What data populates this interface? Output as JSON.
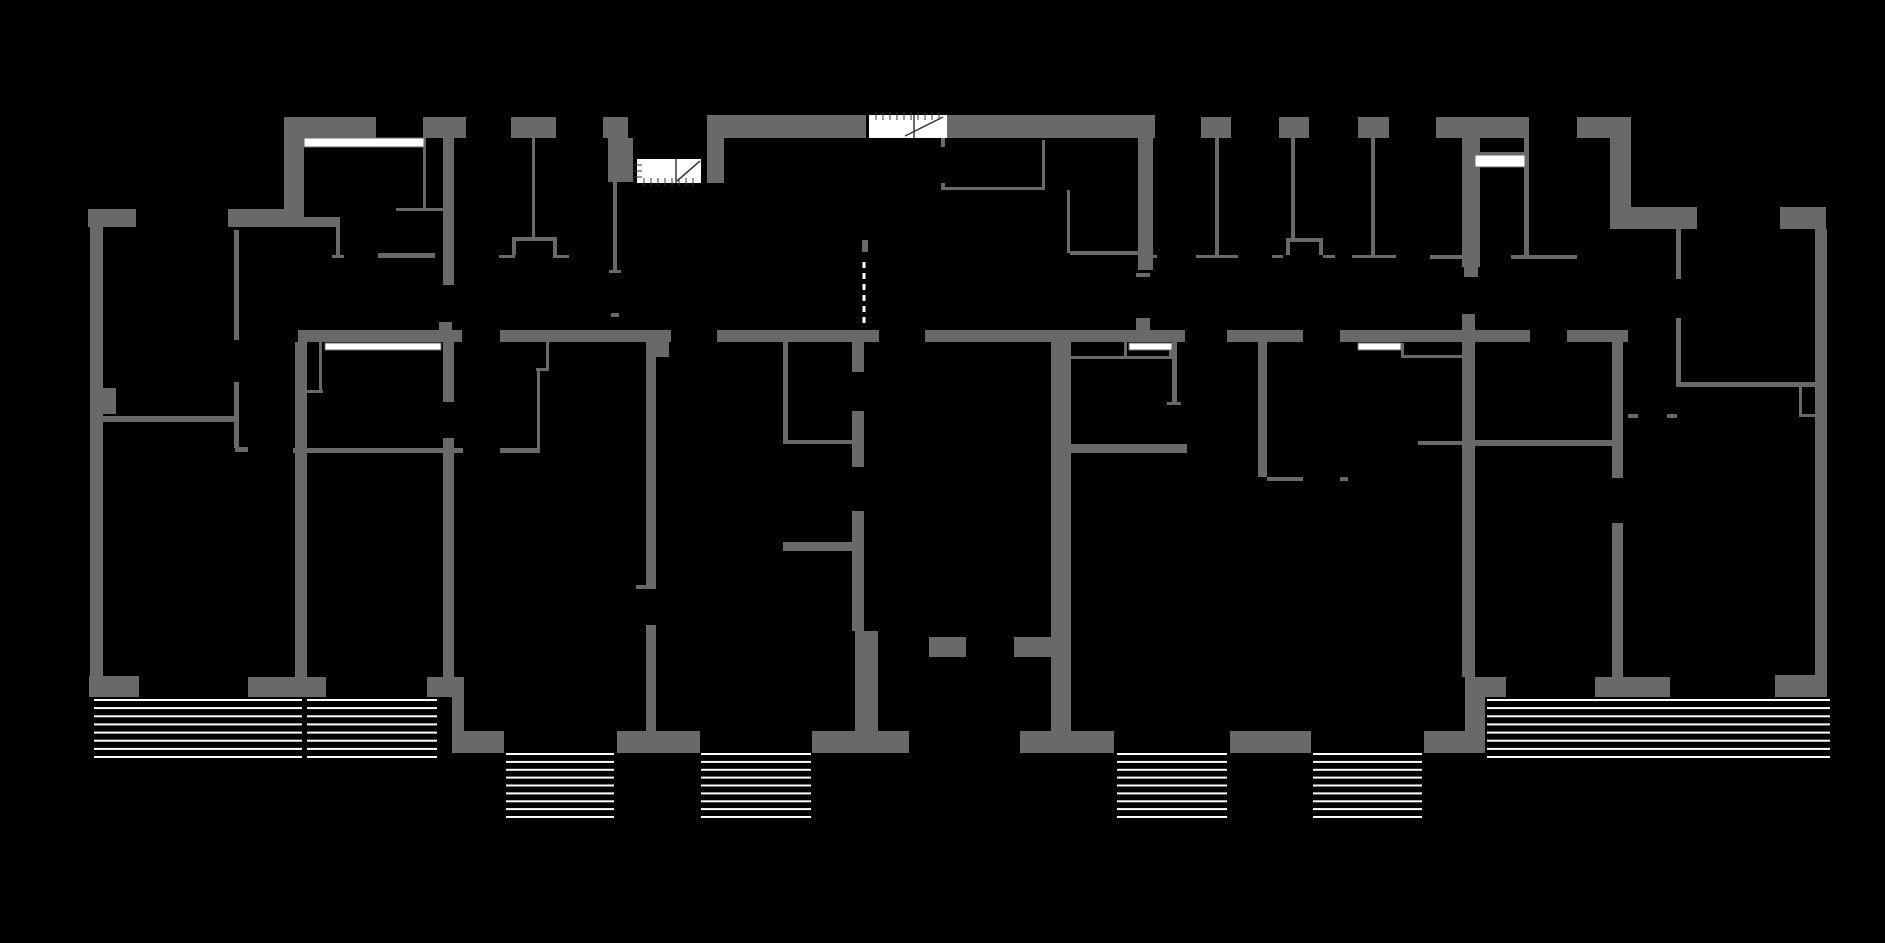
{
  "meta": {
    "canvas": {
      "width": 1885,
      "height": 943
    },
    "colors": {
      "background": "#000000",
      "wall": "#696969",
      "window": "#ffffff",
      "hatch": "#ffffff",
      "stair_fill": "#ffffff",
      "stair_line": "#3a3a3a"
    }
  },
  "walls": [
    [
      284,
      117,
      92,
      21
    ],
    [
      284,
      138,
      20,
      71
    ],
    [
      88,
      209,
      48,
      18
    ],
    [
      228,
      209,
      76,
      18
    ],
    [
      304,
      217,
      36,
      10
    ],
    [
      90,
      227,
      13,
      449
    ],
    [
      103,
      388,
      13,
      26
    ],
    [
      89,
      676,
      50,
      21
    ],
    [
      423,
      117,
      43,
      21
    ],
    [
      443,
      138,
      11,
      147
    ],
    [
      511,
      117,
      45,
      21
    ],
    [
      603,
      117,
      25,
      21
    ],
    [
      608,
      138,
      25,
      44
    ],
    [
      707,
      115,
      159,
      23
    ],
    [
      707,
      138,
      17,
      45
    ],
    [
      942,
      115,
      213,
      23
    ],
    [
      1138,
      138,
      15,
      132
    ],
    [
      1136,
      318,
      14,
      13
    ],
    [
      1201,
      117,
      30,
      21
    ],
    [
      1279,
      117,
      30,
      21
    ],
    [
      1358,
      117,
      31,
      21
    ],
    [
      1436,
      117,
      93,
      21
    ],
    [
      1462,
      138,
      18,
      129
    ],
    [
      1577,
      117,
      54,
      21
    ],
    [
      1610,
      138,
      21,
      73
    ],
    [
      1610,
      207,
      87,
      22
    ],
    [
      1780,
      207,
      46,
      22
    ],
    [
      1815,
      229,
      12,
      468
    ],
    [
      298,
      330,
      164,
      12
    ],
    [
      500,
      330,
      171,
      12
    ],
    [
      717,
      330,
      162,
      12
    ],
    [
      925,
      330,
      260,
      12
    ],
    [
      1227,
      330,
      76,
      12
    ],
    [
      1340,
      330,
      190,
      12
    ],
    [
      1567,
      330,
      61,
      12
    ],
    [
      439,
      322,
      13,
      9
    ],
    [
      295,
      342,
      12,
      335
    ],
    [
      443,
      342,
      11,
      60
    ],
    [
      443,
      438,
      11,
      239
    ],
    [
      248,
      677,
      78,
      20
    ],
    [
      427,
      677,
      37,
      20
    ],
    [
      452,
      697,
      12,
      34
    ],
    [
      452,
      731,
      52,
      22
    ],
    [
      103,
      416,
      134,
      6
    ],
    [
      646,
      341,
      10,
      246
    ],
    [
      646,
      625,
      10,
      106
    ],
    [
      656,
      341,
      13,
      16
    ],
    [
      617,
      731,
      83,
      22
    ],
    [
      783,
      542,
      76,
      9
    ],
    [
      852,
      341,
      12,
      31
    ],
    [
      852,
      411,
      12,
      56
    ],
    [
      852,
      511,
      12,
      120
    ],
    [
      855,
      631,
      23,
      100
    ],
    [
      812,
      731,
      97,
      22
    ],
    [
      929,
      637,
      37,
      20
    ],
    [
      1014,
      637,
      40,
      20
    ],
    [
      1051,
      342,
      20,
      389
    ],
    [
      1020,
      731,
      94,
      22
    ],
    [
      1067,
      444,
      120,
      9
    ],
    [
      1230,
      731,
      81,
      22
    ],
    [
      1258,
      341,
      9,
      136
    ],
    [
      1462,
      314,
      13,
      363
    ],
    [
      1424,
      731,
      61,
      22
    ],
    [
      1465,
      677,
      20,
      54
    ],
    [
      1462,
      440,
      150,
      6
    ],
    [
      1612,
      342,
      11,
      136
    ],
    [
      1612,
      523,
      11,
      154
    ],
    [
      1595,
      677,
      75,
      20
    ],
    [
      1477,
      677,
      29,
      20
    ],
    [
      1775,
      675,
      52,
      22
    ],
    [
      1678,
      382,
      137,
      5
    ]
  ],
  "partitions": [
    [
      234,
      230,
      5,
      110
    ],
    [
      234,
      382,
      5,
      66
    ],
    [
      235,
      447,
      13,
      5
    ],
    [
      293,
      448,
      170,
      5
    ],
    [
      500,
      448,
      40,
      5
    ],
    [
      396,
      208,
      47,
      3
    ],
    [
      423,
      138,
      3,
      70
    ],
    [
      378,
      253,
      57,
      5
    ],
    [
      336,
      227,
      4,
      30
    ],
    [
      332,
      255,
      12,
      3
    ],
    [
      319,
      342,
      3,
      50
    ],
    [
      306,
      390,
      17,
      3
    ],
    [
      546,
      342,
      3,
      28
    ],
    [
      536,
      368,
      13,
      3
    ],
    [
      537,
      371,
      3,
      77
    ],
    [
      532,
      138,
      3,
      99
    ],
    [
      512,
      237,
      45,
      4
    ],
    [
      512,
      241,
      4,
      14
    ],
    [
      553,
      241,
      4,
      14
    ],
    [
      499,
      255,
      16,
      3
    ],
    [
      553,
      255,
      16,
      3
    ],
    [
      613,
      182,
      4,
      91
    ],
    [
      609,
      270,
      12,
      3
    ],
    [
      611,
      313,
      8,
      4
    ],
    [
      941,
      138,
      4,
      9
    ],
    [
      941,
      183,
      4,
      7
    ],
    [
      941,
      187,
      104,
      3
    ],
    [
      1042,
      140,
      3,
      49
    ],
    [
      1067,
      190,
      3,
      63
    ],
    [
      1070,
      251,
      68,
      4
    ],
    [
      1148,
      255,
      9,
      3
    ],
    [
      1136,
      273,
      14,
      4
    ],
    [
      1070,
      356,
      102,
      3
    ],
    [
      1124,
      341,
      3,
      17
    ],
    [
      1169,
      343,
      3,
      15
    ],
    [
      1172,
      342,
      5,
      60
    ],
    [
      1167,
      402,
      14,
      3
    ],
    [
      862,
      240,
      6,
      12
    ],
    [
      636,
      585,
      20,
      4
    ],
    [
      1267,
      477,
      36,
      4
    ],
    [
      1340,
      477,
      8,
      4
    ],
    [
      1215,
      138,
      4,
      117
    ],
    [
      1196,
      255,
      42,
      3
    ],
    [
      1291,
      138,
      4,
      100
    ],
    [
      1286,
      238,
      37,
      4
    ],
    [
      1286,
      242,
      4,
      13
    ],
    [
      1319,
      242,
      4,
      13
    ],
    [
      1272,
      255,
      11,
      3
    ],
    [
      1323,
      255,
      12,
      3
    ],
    [
      1371,
      138,
      4,
      117
    ],
    [
      1352,
      255,
      44,
      3
    ],
    [
      1524,
      138,
      5,
      117
    ],
    [
      1430,
      255,
      50,
      4
    ],
    [
      1464,
      259,
      14,
      18
    ],
    [
      1511,
      255,
      66,
      4
    ],
    [
      1676,
      229,
      5,
      50
    ],
    [
      1676,
      318,
      5,
      69
    ],
    [
      1799,
      387,
      3,
      30
    ],
    [
      1799,
      414,
      16,
      3
    ],
    [
      1628,
      414,
      10,
      4
    ],
    [
      1667,
      414,
      10,
      4
    ],
    [
      1418,
      441,
      46,
      4
    ],
    [
      1403,
      355,
      61,
      3
    ],
    [
      1401,
      343,
      3,
      15
    ],
    [
      1475,
      152,
      54,
      3
    ],
    [
      783,
      341,
      5,
      101
    ],
    [
      783,
      440,
      76,
      4
    ]
  ],
  "windows": [
    [
      304,
      138,
      120,
      9
    ],
    [
      325,
      343,
      116,
      7
    ],
    [
      1129,
      343,
      43,
      7
    ],
    [
      1358,
      343,
      43,
      7
    ],
    [
      1475,
      155,
      50,
      12
    ]
  ],
  "door_dashes": [
    {
      "x": 864,
      "y1": 262,
      "y2": 328
    }
  ],
  "stairs": [
    {
      "x": 637,
      "y": 159,
      "w": 64,
      "h": 24,
      "divider_x": 676,
      "diagonal": [
        700,
        161,
        677,
        181
      ],
      "ticks": "left-bottom"
    },
    {
      "x": 869,
      "y": 115,
      "w": 78,
      "h": 23,
      "divider_x": 914,
      "diagonal": [
        943,
        117,
        905,
        136
      ],
      "ticks": "top"
    }
  ],
  "balconies": [
    {
      "x": 94,
      "y": 700,
      "w": 208,
      "h": 57,
      "lines": 8
    },
    {
      "x": 307,
      "y": 700,
      "w": 130,
      "h": 57,
      "lines": 8
    },
    {
      "x": 506,
      "y": 754,
      "w": 108,
      "h": 63,
      "lines": 9
    },
    {
      "x": 701,
      "y": 754,
      "w": 110,
      "h": 63,
      "lines": 9
    },
    {
      "x": 1117,
      "y": 754,
      "w": 110,
      "h": 63,
      "lines": 9
    },
    {
      "x": 1313,
      "y": 754,
      "w": 109,
      "h": 63,
      "lines": 9
    },
    {
      "x": 1487,
      "y": 700,
      "w": 343,
      "h": 57,
      "lines": 8
    }
  ]
}
